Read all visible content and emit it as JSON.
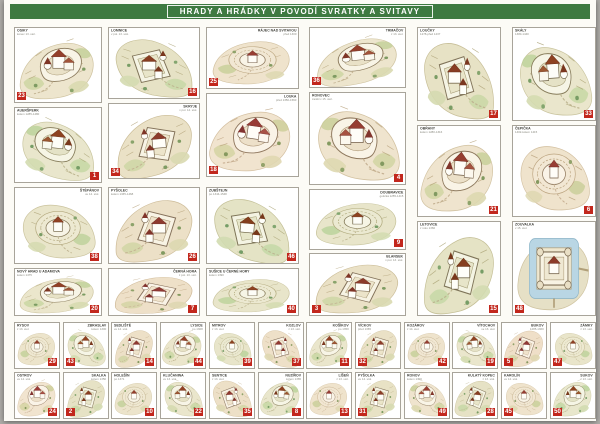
{
  "title": "HRADY A HRÁDKY V POVODÍ SVRATKY A SVITAVY",
  "colors": {
    "title_green": "#3e7a41",
    "badge_red": "#c2271d",
    "paper": "#fcfbf6"
  },
  "panels": [
    {
      "name": "OSIKY",
      "sub": "konec 13. stol.",
      "badge": 23,
      "x": 10,
      "y": 27,
      "w": 88,
      "h": 76,
      "lp": "tl",
      "bp": "bl",
      "art": "a",
      "r": 0,
      "f": 1,
      "hue": 0
    },
    {
      "name": "LOMNICE",
      "sub": "v pol. 13. stol.",
      "badge": 16,
      "x": 104,
      "y": 27,
      "w": 92,
      "h": 72,
      "lp": "tl",
      "bp": "br",
      "art": "b",
      "r": 0,
      "f": -1,
      "hue": 8
    },
    {
      "name": "RÁJEC NAD SVITAVOU",
      "sub": "před 1300",
      "badge": 25,
      "x": 202,
      "y": 27,
      "w": 93,
      "h": 62,
      "lp": "tr",
      "bp": "bl",
      "art": "c",
      "r": 0,
      "f": 1,
      "hue": -6
    },
    {
      "name": "AUERŠPERK",
      "sub": "kolem 1285-1480",
      "badge": 1,
      "x": 10,
      "y": 107,
      "w": 88,
      "h": 76,
      "lp": "tl",
      "bp": "br",
      "art": "a",
      "r": 6,
      "f": -1,
      "hue": 10
    },
    {
      "name": "SKRYJE",
      "sub": "v pol. 14. stol.",
      "badge": 34,
      "x": 104,
      "y": 103,
      "w": 92,
      "h": 76,
      "lp": "tr",
      "bp": "bl",
      "art": "b",
      "r": -5,
      "f": 1,
      "hue": 0
    },
    {
      "name": "LOUKA",
      "sub": "před 1350-1560",
      "badge": 18,
      "x": 202,
      "y": 93,
      "w": 93,
      "h": 84,
      "lp": "tr",
      "bp": "bl",
      "art": "a",
      "r": 8,
      "f": 1,
      "hue": -10
    },
    {
      "name": "ŠTĚPÁNOV",
      "sub": "ve 14. stol.",
      "badge": 38,
      "x": 10,
      "y": 187,
      "w": 88,
      "h": 77,
      "lp": "tr",
      "bp": "br",
      "art": "c",
      "r": 0,
      "f": -1,
      "hue": 6
    },
    {
      "name": "PYŠOLEC",
      "sub": "kolem 1335-1468",
      "badge": 26,
      "x": 104,
      "y": 187,
      "w": 92,
      "h": 77,
      "lp": "tl",
      "bp": "br",
      "art": "b",
      "r": 0,
      "f": 1,
      "hue": -4
    },
    {
      "name": "ZUBŠTEJN",
      "sub": "po 1344-1548",
      "badge": 46,
      "x": 202,
      "y": 187,
      "w": 93,
      "h": 77,
      "lp": "tl",
      "bp": "br",
      "art": "b",
      "r": 5,
      "f": -1,
      "hue": 12
    },
    {
      "name": "NOVÝ HRAD U ADAMOVA",
      "sub": "kolem 1475",
      "badge": 20,
      "x": 10,
      "y": 268,
      "w": 88,
      "h": 48,
      "lp": "tl",
      "bp": "br",
      "art": "a",
      "r": 0,
      "f": 1,
      "hue": 4
    },
    {
      "name": "ČERNÁ HORA",
      "sub": "z pol. 13. stol.",
      "badge": 7,
      "x": 104,
      "y": 268,
      "w": 92,
      "h": 48,
      "lp": "tr",
      "bp": "br",
      "art": "b",
      "r": 3,
      "f": 1,
      "hue": -8
    },
    {
      "name": "SUŠICE U ČERNÉ HORY",
      "sub": "kolem 1390",
      "badge": 40,
      "x": 202,
      "y": 268,
      "w": 93,
      "h": 48,
      "lp": "tl",
      "bp": "br",
      "art": "c",
      "r": 0,
      "f": 1,
      "hue": 8
    },
    {
      "name": "TRMAČOV",
      "sub": "z 13. stol.",
      "badge": 36,
      "x": 305,
      "y": 27,
      "w": 97,
      "h": 61,
      "lp": "tr",
      "bp": "bl",
      "art": "a",
      "r": -6,
      "f": 1,
      "hue": 0
    },
    {
      "name": "RONOVEC",
      "sub": "zanikl v 15. stol.",
      "badge": 4,
      "x": 305,
      "y": 92,
      "w": 97,
      "h": 93,
      "lp": "tl",
      "bp": "br",
      "art": "a",
      "r": 0,
      "f": -1,
      "hue": -6
    },
    {
      "name": "DOUBRAVICE",
      "sub": "gotická 1255-1415",
      "badge": 9,
      "x": 305,
      "y": 189,
      "w": 97,
      "h": 61,
      "lp": "tr",
      "bp": "br",
      "art": "c",
      "r": 0,
      "f": 1,
      "hue": 10
    },
    {
      "name": "BLANSEK",
      "sub": "v pol. 13. stol.",
      "badge": 3,
      "x": 305,
      "y": 253,
      "w": 97,
      "h": 63,
      "lp": "tr",
      "bp": "bl",
      "art": "b",
      "r": 4,
      "f": 1,
      "hue": 0
    },
    {
      "name": "LOUČKY",
      "sub": "1278-před 1437",
      "badge": 17,
      "x": 413,
      "y": 27,
      "w": 84,
      "h": 94,
      "lp": "tl",
      "bp": "br",
      "art": "b",
      "r": 0,
      "f": -1,
      "hue": 6
    },
    {
      "name": "OBŘANY",
      "sub": "kolem 1280-1316",
      "badge": 21,
      "x": 413,
      "y": 125,
      "w": 84,
      "h": 92,
      "lp": "tl",
      "bp": "br",
      "art": "a",
      "r": 5,
      "f": 1,
      "hue": -4
    },
    {
      "name": "LETOVICE",
      "sub": "z roku 1360",
      "badge": 15,
      "x": 413,
      "y": 221,
      "w": 84,
      "h": 95,
      "lp": "tl",
      "bp": "br",
      "art": "b",
      "r": 0,
      "f": 1,
      "hue": 10
    },
    {
      "name": "SKÁLY",
      "sub": "1380-1440",
      "badge": 33,
      "x": 508,
      "y": 27,
      "w": 84,
      "h": 94,
      "lp": "tl",
      "bp": "br",
      "art": "a",
      "r": -4,
      "f": -1,
      "hue": 8
    },
    {
      "name": "ČEPIČKA",
      "sub": "1402-kolem 1415",
      "badge": 6,
      "x": 508,
      "y": 125,
      "w": 84,
      "h": 92,
      "lp": "tl",
      "bp": "br",
      "art": "c",
      "r": 0,
      "f": -1,
      "hue": -8
    },
    {
      "name": "ZOUVALKA",
      "sub": "v 15. stol.",
      "badge": 48,
      "x": 508,
      "y": 221,
      "w": 84,
      "h": 95,
      "lp": "tl",
      "bp": "bl",
      "art": "m",
      "r": 0,
      "f": 1,
      "hue": 0
    },
    {
      "name": "RYSOV",
      "sub": "z 13. stol.",
      "badge": 29,
      "x": 10,
      "y": 322,
      "w": 46,
      "h": 47,
      "lp": "tl",
      "bp": "br",
      "art": "c",
      "r": 0,
      "f": 1,
      "hue": 0
    },
    {
      "name": "ZBRASLAV",
      "sub": "kolem 1300",
      "badge": 43,
      "x": 59,
      "y": 322,
      "w": 46,
      "h": 47,
      "lp": "tr",
      "bp": "bl",
      "art": "a",
      "r": 0,
      "f": -1,
      "hue": 8
    },
    {
      "name": "SEDLIŠTĚ",
      "sub": "ve 14. stol.",
      "badge": 14,
      "x": 107,
      "y": 322,
      "w": 46,
      "h": 47,
      "lp": "tl",
      "bp": "br",
      "art": "b",
      "r": 0,
      "f": 1,
      "hue": -6
    },
    {
      "name": "LYSICE",
      "sub": "po 1308",
      "badge": 44,
      "x": 156,
      "y": 322,
      "w": 46,
      "h": 47,
      "lp": "tr",
      "bp": "br",
      "art": "a",
      "r": 6,
      "f": 1,
      "hue": 4
    },
    {
      "name": "MITROV",
      "sub": "z 13. stol.",
      "badge": 39,
      "x": 205,
      "y": 322,
      "w": 46,
      "h": 47,
      "lp": "tl",
      "bp": "br",
      "art": "c",
      "r": 0,
      "f": -1,
      "hue": 10
    },
    {
      "name": "KOZLOV",
      "sub": "z 13. stol.",
      "badge": 37,
      "x": 254,
      "y": 322,
      "w": 46,
      "h": 47,
      "lp": "tr",
      "bp": "br",
      "art": "b",
      "r": 0,
      "f": -1,
      "hue": -8
    },
    {
      "name": "KOŠÍKOV",
      "sub": "po 1350",
      "badge": 11,
      "x": 302,
      "y": 322,
      "w": 46,
      "h": 47,
      "lp": "tr",
      "bp": "br",
      "art": "a",
      "r": 0,
      "f": 1,
      "hue": 6
    },
    {
      "name": "VÍCKOV",
      "sub": "před 1365",
      "badge": 32,
      "x": 351,
      "y": 322,
      "w": 46,
      "h": 47,
      "lp": "tl",
      "bp": "bl",
      "art": "b",
      "r": 0,
      "f": 1,
      "hue": 0
    },
    {
      "name": "KOZÁROV",
      "sub": "z 14. stol.",
      "badge": 42,
      "x": 400,
      "y": 322,
      "w": 46,
      "h": 47,
      "lp": "tl",
      "bp": "br",
      "art": "c",
      "r": 0,
      "f": 1,
      "hue": -4
    },
    {
      "name": "VÍTOCHOV",
      "sub": "ve 13. stol.",
      "badge": 19,
      "x": 448,
      "y": 322,
      "w": 46,
      "h": 47,
      "lp": "tr",
      "bp": "br",
      "art": "a",
      "r": -5,
      "f": -1,
      "hue": 8
    },
    {
      "name": "BUKOV",
      "sub": "1285-1360",
      "badge": 5,
      "x": 497,
      "y": 322,
      "w": 46,
      "h": 47,
      "lp": "tr",
      "bp": "bl",
      "art": "b",
      "r": 4,
      "f": 1,
      "hue": -10
    },
    {
      "name": "ZÁMKY",
      "sub": "z 13. stol.",
      "badge": 47,
      "x": 546,
      "y": 322,
      "w": 46,
      "h": 47,
      "lp": "tr",
      "bp": "bl",
      "art": "c",
      "r": 0,
      "f": -1,
      "hue": 6
    },
    {
      "name": "OSTROV",
      "sub": "ve 14. stol.",
      "badge": 24,
      "x": 10,
      "y": 372,
      "w": 46,
      "h": 47,
      "lp": "tl",
      "bp": "br",
      "art": "a",
      "r": 0,
      "f": 1,
      "hue": -10
    },
    {
      "name": "SKALKA",
      "sub": "kolem 1350",
      "badge": 2,
      "x": 59,
      "y": 372,
      "w": 46,
      "h": 47,
      "lp": "tr",
      "bp": "bl",
      "art": "b",
      "r": 0,
      "f": 1,
      "hue": 8
    },
    {
      "name": "HOLEŠÍN",
      "sub": "po 1371",
      "badge": 10,
      "x": 107,
      "y": 372,
      "w": 46,
      "h": 47,
      "lp": "tl",
      "bp": "br",
      "art": "c",
      "r": 0,
      "f": 1,
      "hue": 0
    },
    {
      "name": "KLUČANINA",
      "sub": "ve 13. stol.",
      "badge": 22,
      "x": 156,
      "y": 372,
      "w": 46,
      "h": 47,
      "lp": "tl",
      "bp": "br",
      "art": "a",
      "r": 0,
      "f": -1,
      "hue": 6
    },
    {
      "name": "SENTICE",
      "sub": "z 13. stol.",
      "badge": 35,
      "x": 205,
      "y": 372,
      "w": 46,
      "h": 47,
      "lp": "tl",
      "bp": "br",
      "art": "b",
      "r": -4,
      "f": -1,
      "hue": -6
    },
    {
      "name": "NUZÍŘOV",
      "sub": "kolem 1365",
      "badge": 8,
      "x": 254,
      "y": 372,
      "w": 46,
      "h": 47,
      "lp": "tr",
      "bp": "br",
      "art": "a",
      "r": 5,
      "f": 1,
      "hue": 10
    },
    {
      "name": "LÍŠEŇ",
      "sub": "z 13. stol.",
      "badge": 13,
      "x": 302,
      "y": 372,
      "w": 46,
      "h": 47,
      "lp": "tr",
      "bp": "br",
      "art": "c",
      "r": 0,
      "f": 1,
      "hue": -8
    },
    {
      "name": "PYŠOLKA",
      "sub": "ve 14. stol.",
      "badge": 31,
      "x": 351,
      "y": 372,
      "w": 46,
      "h": 47,
      "lp": "tl",
      "bp": "bl",
      "art": "b",
      "r": 0,
      "f": 1,
      "hue": 4
    },
    {
      "name": "RONOV",
      "sub": "kolem 1300",
      "badge": 49,
      "x": 400,
      "y": 372,
      "w": 46,
      "h": 47,
      "lp": "tl",
      "bp": "br",
      "art": "a",
      "r": 0,
      "f": -1,
      "hue": -4
    },
    {
      "name": "KULATÝ KOPEC",
      "sub": "z 13. stol.",
      "badge": 28,
      "x": 448,
      "y": 372,
      "w": 46,
      "h": 47,
      "lp": "tr",
      "bp": "br",
      "art": "b",
      "r": 6,
      "f": 1,
      "hue": 8
    },
    {
      "name": "KAROLÍN",
      "sub": "ve 14. stol.",
      "badge": 45,
      "x": 497,
      "y": 372,
      "w": 46,
      "h": 47,
      "lp": "tl",
      "bp": "bl",
      "art": "c",
      "r": 0,
      "f": -1,
      "hue": -6
    },
    {
      "name": "SUKOV",
      "sub": "z 13. stol.",
      "badge": 50,
      "x": 546,
      "y": 372,
      "w": 46,
      "h": 47,
      "lp": "tr",
      "bp": "bl",
      "art": "a",
      "r": 0,
      "f": 1,
      "hue": 12
    }
  ]
}
